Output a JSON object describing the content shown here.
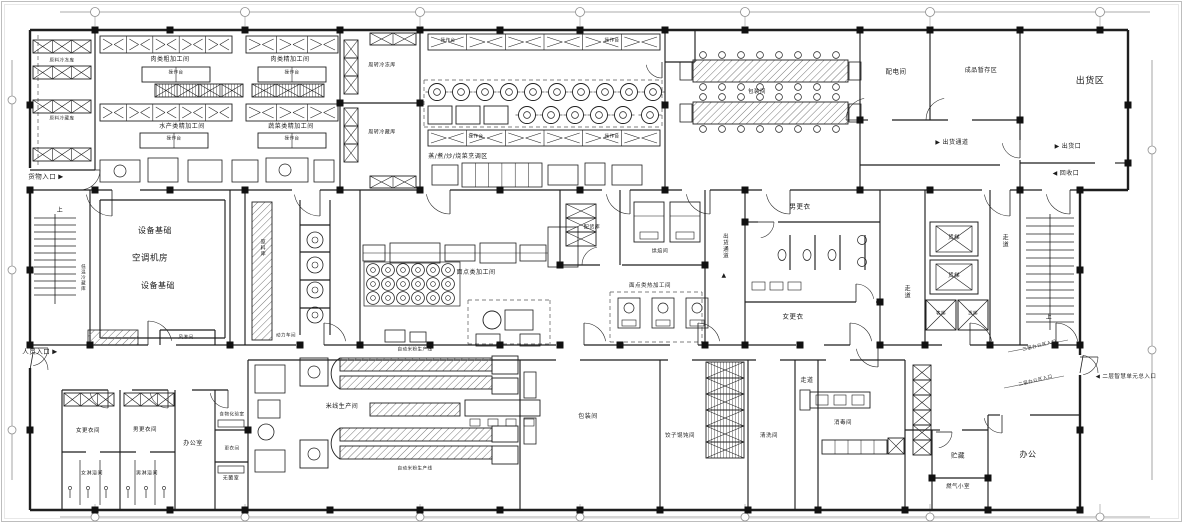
{
  "colors": {
    "line": "#1f1f1f",
    "dim_line": "#8f8f8f",
    "paper": "#ffffff",
    "rack_fill": "#c9c9c9"
  },
  "plan": {
    "labels": [
      {
        "n": "room-raw-freezer",
        "t": "原料冷冻库",
        "x": 62,
        "y": 62,
        "fs": 4.5
      },
      {
        "n": "room-raw-cold-store",
        "t": "原料冷藏库",
        "x": 62,
        "y": 120,
        "fs": 4.5
      },
      {
        "n": "goods-entrance",
        "t": "货物入口",
        "x": 46,
        "y": 177,
        "fs": 6.5,
        "post": "▶",
        "ic": "goods-entrance-arrow-icon"
      },
      {
        "n": "stair-up-left",
        "t": "上",
        "x": 60,
        "y": 211,
        "fs": 6
      },
      {
        "n": "room-lowtemp-cold-store",
        "t": "低温冷藏库",
        "x": 82,
        "y": 278,
        "fs": 4.5,
        "v": true
      },
      {
        "n": "personnel-entrance",
        "t": "人员入口",
        "x": 40,
        "y": 352,
        "fs": 6.5,
        "post": "▶",
        "ic": "personnel-entrance-arrow-icon"
      },
      {
        "n": "equipment-base-1",
        "t": "设备基础",
        "x": 155,
        "y": 231,
        "fs": 8
      },
      {
        "n": "room-hvac",
        "t": "空调机房",
        "x": 150,
        "y": 259,
        "fs": 8.5
      },
      {
        "n": "equipment-base-2",
        "t": "设备基础",
        "x": 158,
        "y": 286,
        "fs": 8
      },
      {
        "n": "room-air-shower",
        "t": "风淋间",
        "x": 186,
        "y": 339,
        "fs": 4.5
      },
      {
        "n": "room-meat-rough",
        "t": "肉类粗加工间",
        "x": 170,
        "y": 60,
        "fs": 6
      },
      {
        "n": "room-meat-fine",
        "t": "肉类精加工间",
        "x": 290,
        "y": 60,
        "fs": 6
      },
      {
        "n": "worktable-1",
        "t": "操作台",
        "x": 176,
        "y": 74,
        "fs": 4.5
      },
      {
        "n": "worktable-2",
        "t": "操作台",
        "x": 292,
        "y": 74,
        "fs": 4.5
      },
      {
        "n": "room-seafood-fine",
        "t": "水产类精加工间",
        "x": 182,
        "y": 127,
        "fs": 6
      },
      {
        "n": "room-veg-fine",
        "t": "蔬菜类精加工间",
        "x": 291,
        "y": 127,
        "fs": 6
      },
      {
        "n": "worktable-3",
        "t": "操作台",
        "x": 174,
        "y": 140,
        "fs": 4.5
      },
      {
        "n": "worktable-4",
        "t": "操作台",
        "x": 292,
        "y": 140,
        "fs": 4.5
      },
      {
        "n": "room-turnover-freezer",
        "t": "周转冷冻库",
        "x": 382,
        "y": 66,
        "fs": 5
      },
      {
        "n": "room-turnover-cold",
        "t": "周转冷藏库",
        "x": 382,
        "y": 133,
        "fs": 5
      },
      {
        "n": "worktable-5",
        "t": "操作台",
        "x": 448,
        "y": 42,
        "fs": 4.5
      },
      {
        "n": "worktable-6",
        "t": "操作台",
        "x": 612,
        "y": 42,
        "fs": 4.5
      },
      {
        "n": "worktable-7",
        "t": "操作台",
        "x": 476,
        "y": 138,
        "fs": 4.5
      },
      {
        "n": "worktable-8",
        "t": "操作台",
        "x": 612,
        "y": 138,
        "fs": 4.5
      },
      {
        "n": "zone-cooking",
        "t": "蒸/煮/炒/烧菜烹调区",
        "x": 458,
        "y": 157,
        "fs": 6
      },
      {
        "n": "room-pastry",
        "t": "面点类加工间",
        "x": 476,
        "y": 273,
        "fs": 6
      },
      {
        "n": "room-distribution-store",
        "t": "配货库",
        "x": 592,
        "y": 228,
        "fs": 5
      },
      {
        "n": "room-baking",
        "t": "烘焙间",
        "x": 660,
        "y": 252,
        "fs": 5
      },
      {
        "n": "room-pastry-hot",
        "t": "面点类热加工间",
        "x": 650,
        "y": 287,
        "fs": 5.5
      },
      {
        "n": "corridor-shipping-mid",
        "t": "出货通道",
        "x": 724,
        "y": 246,
        "fs": 5.5,
        "v": true
      },
      {
        "n": "shipping-corridor-up-arrow-icon",
        "t": "▲",
        "x": 724,
        "y": 276,
        "fs": 6
      },
      {
        "n": "room-packing-top",
        "t": "包装间",
        "x": 757,
        "y": 93,
        "fs": 5.5
      },
      {
        "n": "room-men-changing",
        "t": "男更衣",
        "x": 800,
        "y": 207,
        "fs": 6.5
      },
      {
        "n": "room-women-changing",
        "t": "女更衣",
        "x": 793,
        "y": 317,
        "fs": 6.5
      },
      {
        "n": "corridor-elevator",
        "t": "走道",
        "x": 906,
        "y": 292,
        "fs": 6,
        "v": true
      },
      {
        "n": "elevator-freight-1",
        "t": "货梯",
        "x": 954,
        "y": 239,
        "fs": 5.5
      },
      {
        "n": "elevator-freight-2",
        "t": "货梯",
        "x": 954,
        "y": 277,
        "fs": 5.5
      },
      {
        "n": "elevator-passenger",
        "t": "客梯",
        "x": 941,
        "y": 315,
        "fs": 4.5
      },
      {
        "n": "elevator-freight-3",
        "t": "货梯",
        "x": 973,
        "y": 315,
        "fs": 4.5
      },
      {
        "n": "corridor-right",
        "t": "走道",
        "x": 1004,
        "y": 241,
        "fs": 6,
        "v": true
      },
      {
        "n": "stair-up-right",
        "t": "上",
        "x": 1049,
        "y": 318,
        "fs": 6
      },
      {
        "n": "room-electrical",
        "t": "配电间",
        "x": 896,
        "y": 72,
        "fs": 6.5
      },
      {
        "n": "room-finished-storage",
        "t": "成品暂存区",
        "x": 981,
        "y": 71,
        "fs": 6
      },
      {
        "n": "zone-shipping",
        "t": "出货区",
        "x": 1090,
        "y": 82,
        "fs": 9
      },
      {
        "n": "corridor-shipping-top",
        "t": "出货通道",
        "x": 952,
        "y": 143,
        "fs": 6,
        "pre": "▶",
        "ic": "shipping-corridor-arrow-icon"
      },
      {
        "n": "shipping-exit",
        "t": "出货口",
        "x": 1068,
        "y": 147,
        "fs": 6,
        "pre": "▶",
        "ic": "shipping-exit-arrow-icon"
      },
      {
        "n": "recycle-entrance",
        "t": "回收口",
        "x": 1066,
        "y": 174,
        "fs": 6,
        "pre": "◀",
        "ic": "recycle-arrow-icon"
      },
      {
        "n": "corridor-bottom",
        "t": "走道",
        "x": 807,
        "y": 381,
        "fs": 6
      },
      {
        "n": "room-disinfection",
        "t": "消毒间",
        "x": 843,
        "y": 424,
        "fs": 5.5
      },
      {
        "n": "room-washing",
        "t": "清洗间",
        "x": 769,
        "y": 437,
        "fs": 5.5
      },
      {
        "n": "room-dumpling",
        "t": "饺子馄饨间",
        "x": 680,
        "y": 437,
        "fs": 5.5
      },
      {
        "n": "room-packing-bottom",
        "t": "包装间",
        "x": 588,
        "y": 417,
        "fs": 6
      },
      {
        "n": "room-rice-noodle",
        "t": "米线生产间",
        "x": 342,
        "y": 407,
        "fs": 6
      },
      {
        "n": "line-rice-noodle-1",
        "t": "自动米粉生产线",
        "x": 415,
        "y": 351,
        "fs": 4.5
      },
      {
        "n": "line-rice-noodle-2",
        "t": "自动米粉生产线",
        "x": 415,
        "y": 470,
        "fs": 4.5
      },
      {
        "n": "room-power",
        "t": "动力车间",
        "x": 286,
        "y": 337,
        "fs": 4.5
      },
      {
        "n": "room-women-locker",
        "t": "女更衣间",
        "x": 88,
        "y": 432,
        "fs": 5.5
      },
      {
        "n": "room-men-locker",
        "t": "男更衣间",
        "x": 145,
        "y": 431,
        "fs": 5.5
      },
      {
        "n": "room-women-shower",
        "t": "女淋浴间",
        "x": 92,
        "y": 474,
        "fs": 5
      },
      {
        "n": "room-men-shower",
        "t": "男淋浴间",
        "x": 147,
        "y": 474,
        "fs": 5
      },
      {
        "n": "room-office-small",
        "t": "办公室",
        "x": 193,
        "y": 444,
        "fs": 6
      },
      {
        "n": "room-food-lab",
        "t": "食物化验室",
        "x": 232,
        "y": 416,
        "fs": 4.5
      },
      {
        "n": "room-locker-small",
        "t": "更衣间",
        "x": 232,
        "y": 450,
        "fs": 4.5
      },
      {
        "n": "room-sterile",
        "t": "无菌室",
        "x": 231,
        "y": 479,
        "fs": 5
      },
      {
        "n": "room-storage",
        "t": "贮藏",
        "x": 958,
        "y": 456,
        "fs": 6.5
      },
      {
        "n": "room-office",
        "t": "办公",
        "x": 1028,
        "y": 455,
        "fs": 8
      },
      {
        "n": "room-gas",
        "t": "燃气小室",
        "x": 958,
        "y": 488,
        "fs": 5.5
      },
      {
        "n": "entrance-2f",
        "t": "二层智慧单元总入口",
        "x": 1126,
        "y": 378,
        "fs": 5.5,
        "pre": "◀",
        "ic": "entrance-2f-arrow-icon"
      },
      {
        "n": "annotation-2f-entry-1",
        "t": "二层办公区入口",
        "x": 1040,
        "y": 347,
        "fs": 4.5,
        "r": -14
      },
      {
        "n": "annotation-2f-entry-2",
        "t": "二层办公区入口",
        "x": 1036,
        "y": 382,
        "fs": 4.5,
        "r": -14
      },
      {
        "n": "label-raw-material-store",
        "t": "原料库",
        "x": 262,
        "y": 248,
        "fs": 5,
        "v": true
      }
    ]
  }
}
